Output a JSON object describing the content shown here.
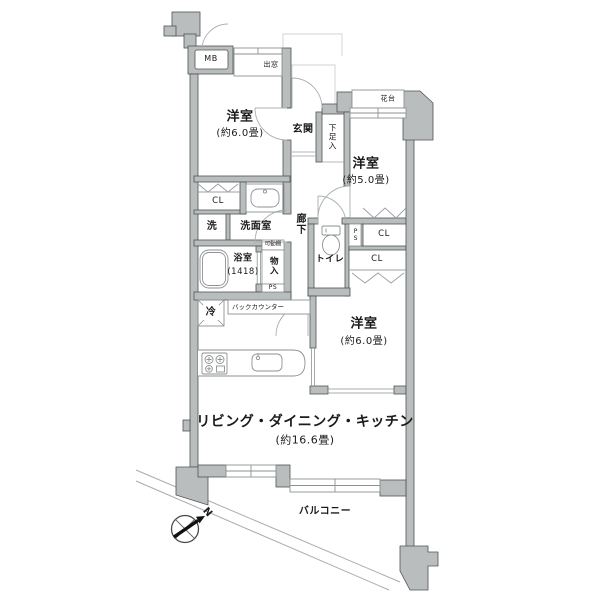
{
  "page": {
    "type": "apartment-floor-plan"
  },
  "colors": {
    "background": "#ffffff",
    "wall_fill": "#b9bdbd",
    "wall_edge": "#4f5454",
    "fixture_line": "#8d9292",
    "door_arc": "#aab0b0",
    "balcony_line": "#a8acac",
    "text": "#1b1b1b"
  },
  "rooms": {
    "bedroom1": {
      "name": "洋室",
      "size": "(約6.0畳)"
    },
    "bedroom2": {
      "name": "洋室",
      "size": "(約5.0畳)"
    },
    "bedroom3": {
      "name": "洋室",
      "size": "(約6.0畳)"
    },
    "ldk": {
      "name": "リビング・ダイニング・キッチン",
      "size": "(約16.6畳)"
    },
    "entrance": {
      "name": "玄関"
    },
    "hallway": {
      "name": "廊下"
    },
    "washroom": {
      "name": "洗面室"
    },
    "laundry": {
      "name": "洗"
    },
    "bathroom": {
      "name": "浴室",
      "size": "(1418)"
    },
    "toilet": {
      "name": "トイレ"
    },
    "balcony": {
      "name": "バルコニー"
    }
  },
  "fixtures": {
    "meter_box": "MB",
    "bay_window": "出窓",
    "flower_shelf": "花台",
    "shoe_cabinet": "下足入",
    "closet_a": "CL",
    "closet_b": "CL",
    "closet_c": "CL",
    "movable_shelf": "可動棚",
    "storage": "物入",
    "pipe_space_a": "PS",
    "pipe_space_b": "PS",
    "refrigerator": "冷",
    "back_counter": "バックカウンター"
  },
  "compass": {
    "north": "N"
  }
}
